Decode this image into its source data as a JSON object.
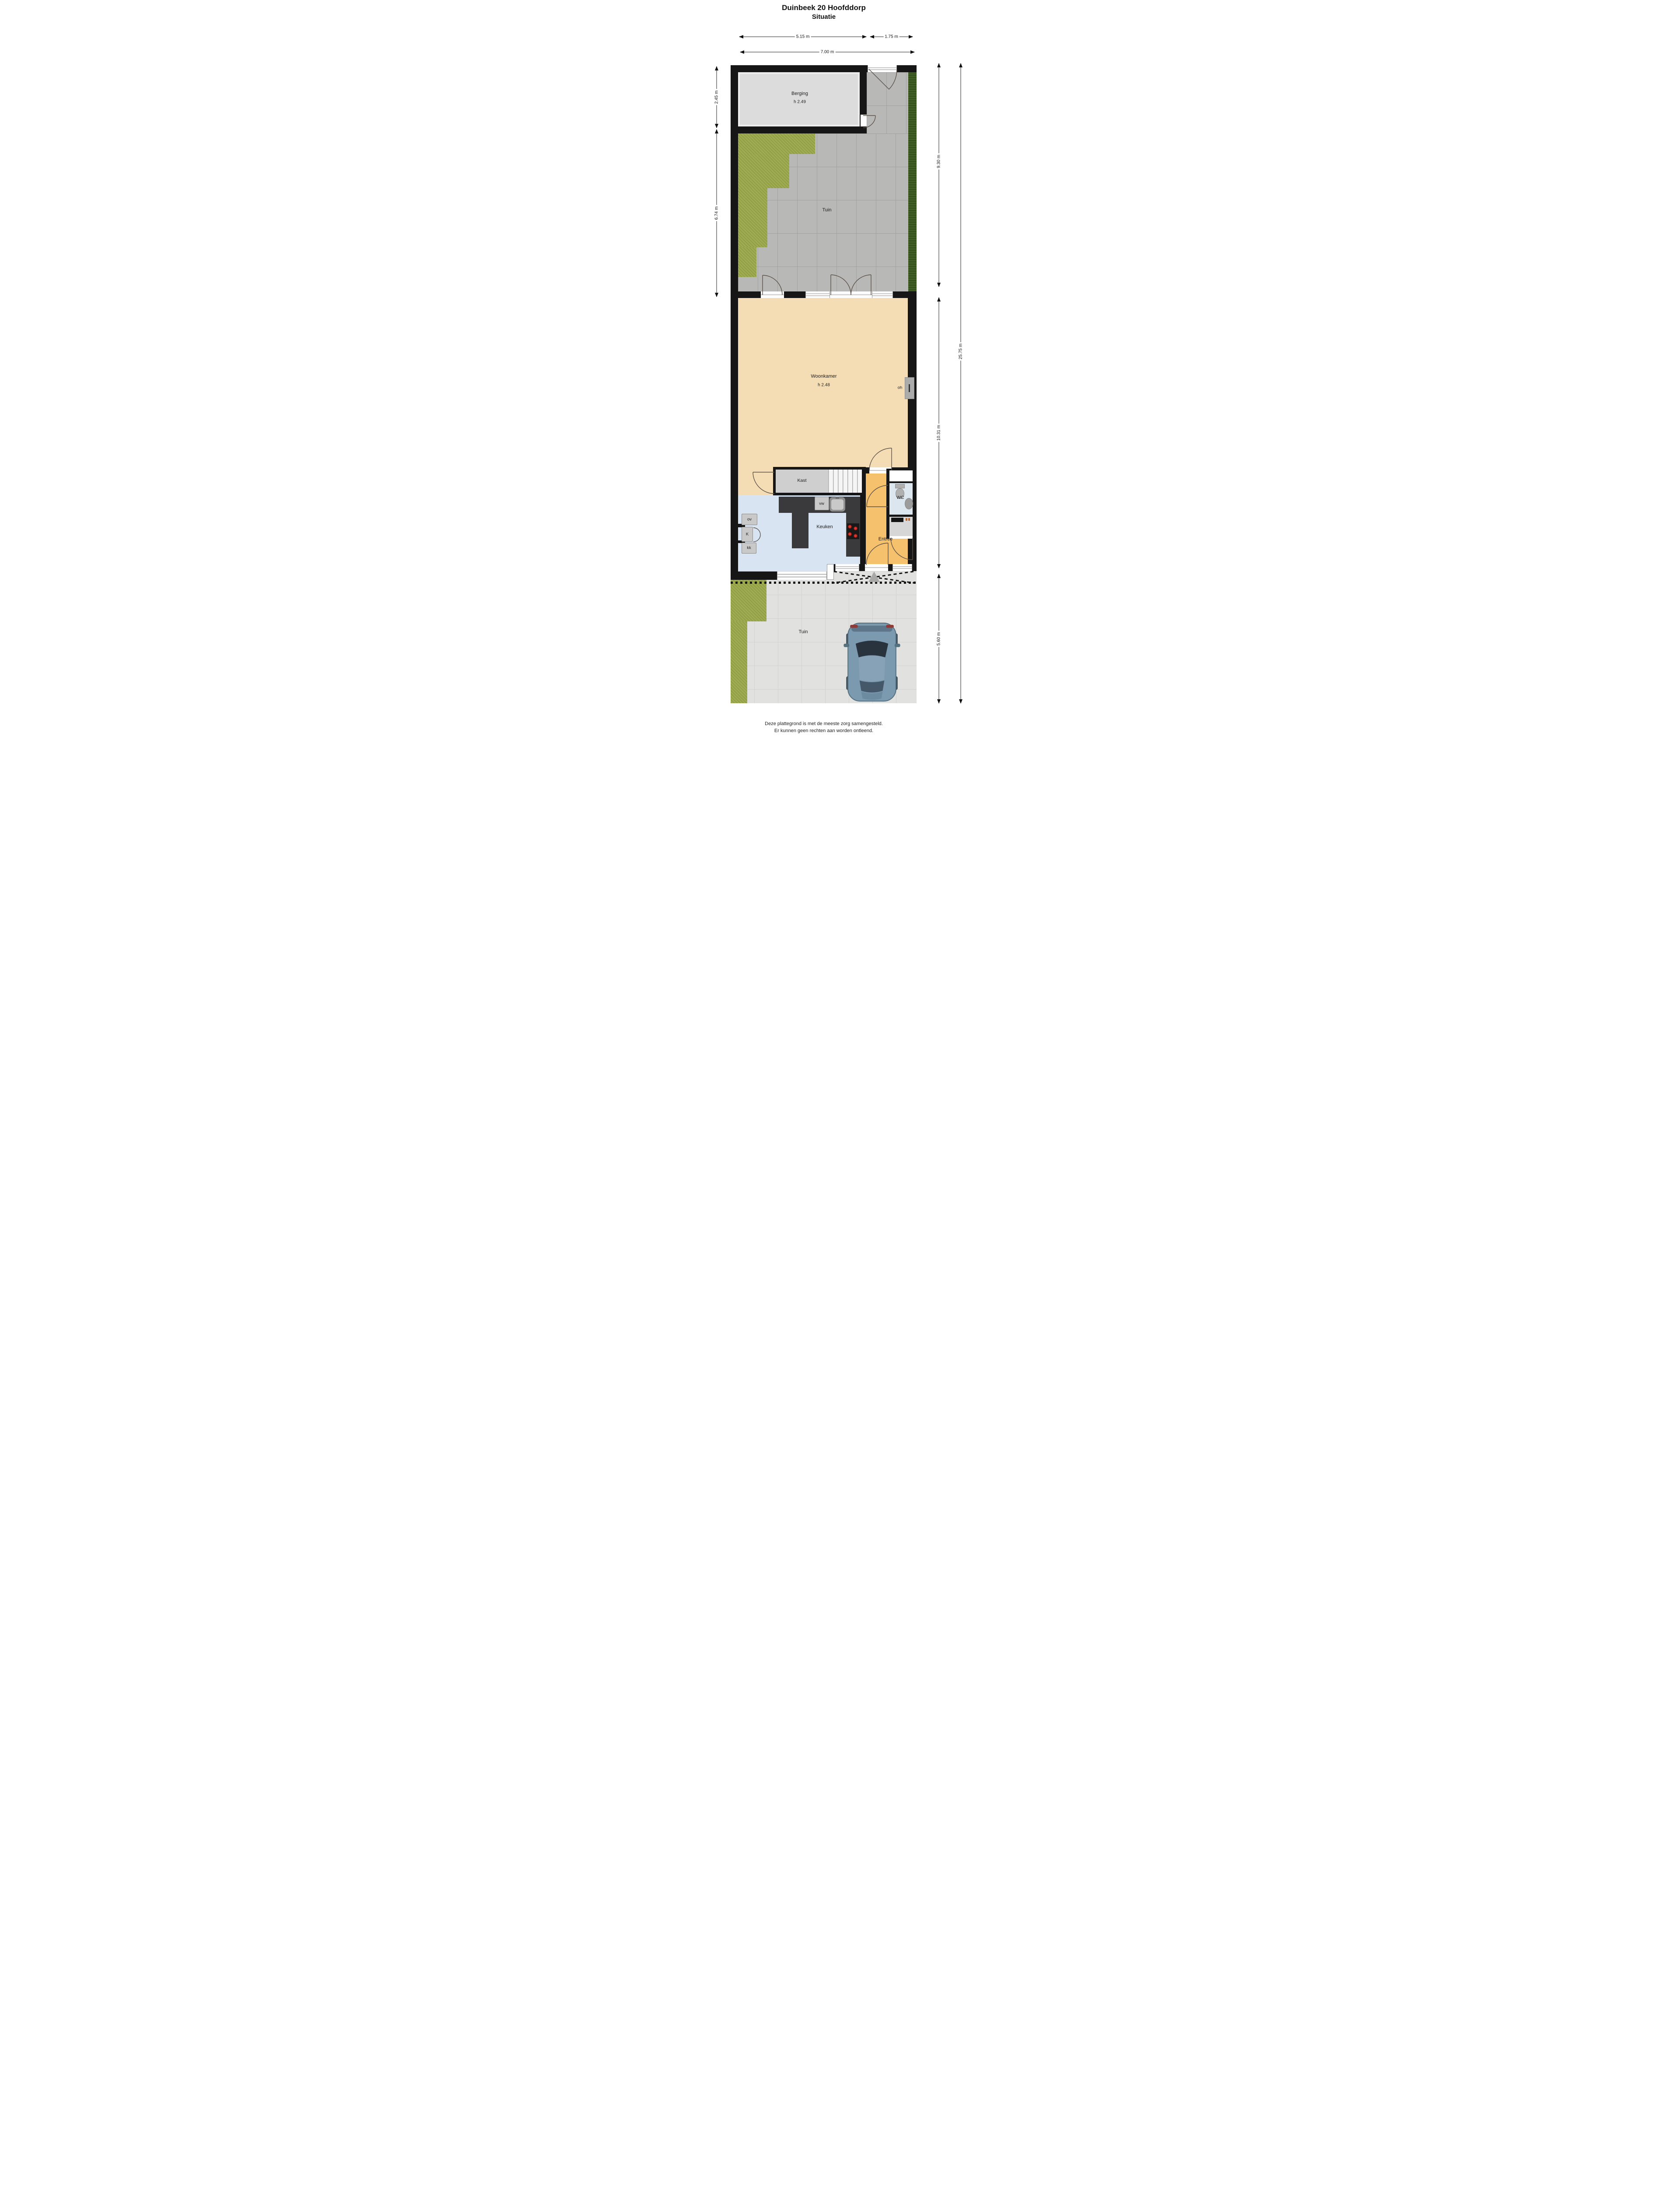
{
  "title": {
    "line1": "Duinbeek 20 Hoofddorp",
    "line2": "Situatie"
  },
  "dimensions": {
    "top_row": [
      {
        "label": "5.15 m"
      },
      {
        "label": "1.75 m"
      }
    ],
    "top_total": {
      "label": "7.00 m"
    },
    "left": [
      {
        "label": "2.45 m"
      },
      {
        "label": "6.74 m"
      }
    ],
    "right": [
      {
        "label": "9.30 m"
      },
      {
        "label": "10.31 m"
      },
      {
        "label": "5.60 m"
      }
    ],
    "right_total": {
      "label": "25.75 m"
    }
  },
  "rooms": {
    "berging": {
      "name": "Berging",
      "ceiling": "h 2.49"
    },
    "tuin_back": {
      "name": "Tuin"
    },
    "woonkamer": {
      "name": "Woonkamer",
      "ceiling": "h 2.48"
    },
    "kast": {
      "name": "Kast"
    },
    "keuken": {
      "name": "Keuken"
    },
    "wc": {
      "name": "WC"
    },
    "entree": {
      "name": "Entree"
    },
    "tuin_front": {
      "name": "Tuin"
    }
  },
  "fixtures": {
    "oh": "oh",
    "vw": "vw",
    "ov": "ov",
    "koelkast": "K",
    "kk": "kk"
  },
  "footer": {
    "line1": "Deze plattegrond is met de meeste zorg samengesteld.",
    "line2": "Er kunnen geen rechten aan worden ontleend."
  },
  "colors": {
    "wall": "#161616",
    "woonkamer_floor": "#f4ddb5",
    "keuken_floor": "#d8e4f2",
    "entree_floor": "#f6c16d",
    "wc_floor": "#dce6ef",
    "berging_floor": "#dcdcdc",
    "grass": "#a0ad52",
    "hedge": "#466429",
    "pavers_back": "#b8b8b6",
    "pavers_front": "#e1e1df",
    "counter": "#3a3a3c",
    "burner_red": "#c5261f",
    "car_body": "#7b99af"
  }
}
